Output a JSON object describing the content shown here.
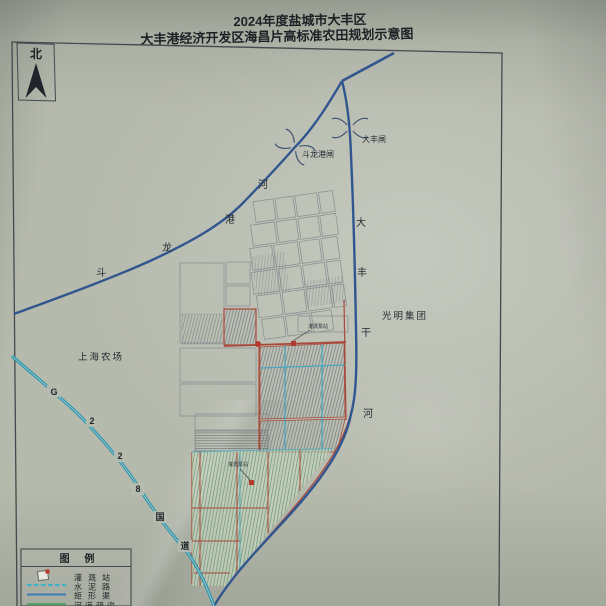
{
  "title": {
    "line1": "2024年度盐城市大丰区",
    "line2": "大丰港经济开发区海昌片高标准农田规划示意图"
  },
  "compass": {
    "label": "北"
  },
  "map": {
    "rivers": {
      "doulonggang": {
        "chars": [
          "斗",
          "龙",
          "港",
          "河"
        ]
      },
      "dafengganhe": {
        "chars": [
          "大",
          "丰",
          "干",
          "河"
        ]
      }
    },
    "gates": [
      {
        "name": "斗龙港闸"
      },
      {
        "name": "大丰闸"
      }
    ],
    "road_g228": {
      "chars": [
        "G",
        "2",
        "2",
        "8",
        "国",
        "道"
      ]
    },
    "areas": [
      {
        "name": "上海农场"
      },
      {
        "name": "光明集团"
      }
    ],
    "annotations": [
      {
        "text": "灌溉泵站"
      },
      {
        "text": "灌溉泵站"
      }
    ]
  },
  "legend": {
    "title": "图 例",
    "rows": [
      {
        "symbol": "irrigation-station",
        "label": "灌溉站"
      },
      {
        "symbol": "cement-road",
        "label": "水泥路"
      },
      {
        "symbol": "rectangular-channel",
        "label": "矩形渠"
      },
      {
        "symbol": "river-dredging",
        "label": "河道疏浚"
      }
    ]
  },
  "colors": {
    "paper": "#b6baad",
    "river_blue": "#31568f",
    "road_teal": "#2e96ad",
    "boundary_red": "#a8483a",
    "channel_cyan": "#4aa7bd",
    "field_green": "#5f9169"
  }
}
